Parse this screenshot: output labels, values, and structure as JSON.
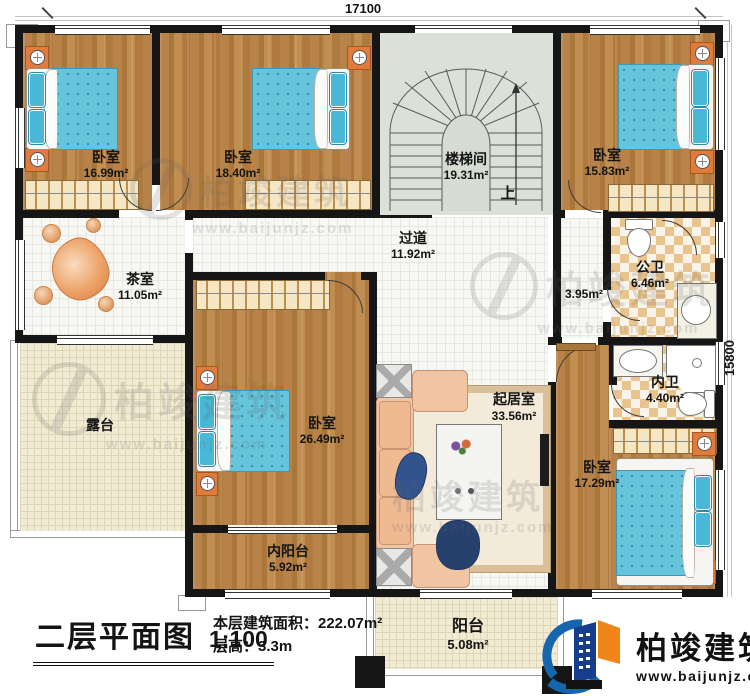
{
  "dimensions": {
    "top": "17100",
    "right": "15800"
  },
  "rooms": {
    "bedroom_tl": {
      "label": "卧室",
      "area": "16.99m²"
    },
    "bedroom_tm": {
      "label": "卧室",
      "area": "18.40m²"
    },
    "stairwell": {
      "label": "楼梯间",
      "area": "19.31m²",
      "direction": "上"
    },
    "bedroom_tr": {
      "label": "卧室",
      "area": "15.83m²"
    },
    "tea_room": {
      "label": "茶室",
      "area": "11.05m²"
    },
    "hallway": {
      "label": "过道",
      "area": "11.92m²"
    },
    "closet": {
      "area": "3.95m²"
    },
    "public_bath": {
      "label": "公卫",
      "area": "6.46m²"
    },
    "inner_bath": {
      "label": "内卫",
      "area": "4.40m²"
    },
    "bedroom_c": {
      "label": "卧室",
      "area": "26.49m²"
    },
    "living": {
      "label": "起居室",
      "area": "33.56m²"
    },
    "bedroom_br": {
      "label": "卧室",
      "area": "17.29m²"
    },
    "inner_balcony": {
      "label": "内阳台",
      "area": "5.92m²"
    },
    "terrace": {
      "label": "露台"
    },
    "balcony": {
      "label": "阳台",
      "area": "5.08m²"
    }
  },
  "title_block": {
    "plan_title": "二层平面图",
    "scale": "1:100",
    "floor_area": "本层建筑面积：222.07m²",
    "floor_height": "层高：3.3m"
  },
  "brand": {
    "name": "柏竣建筑",
    "website": "www.baijunjz.com"
  },
  "watermark": {
    "name": "柏竣建筑",
    "website": "www.baijunjz.com"
  },
  "colors": {
    "wall": "#161616",
    "wood": "#b5803f",
    "bed_blue": "#66c4db",
    "brand_blue": "#1666ad",
    "brand_navy": "#173e8d",
    "brand_orange": "#f08619"
  }
}
